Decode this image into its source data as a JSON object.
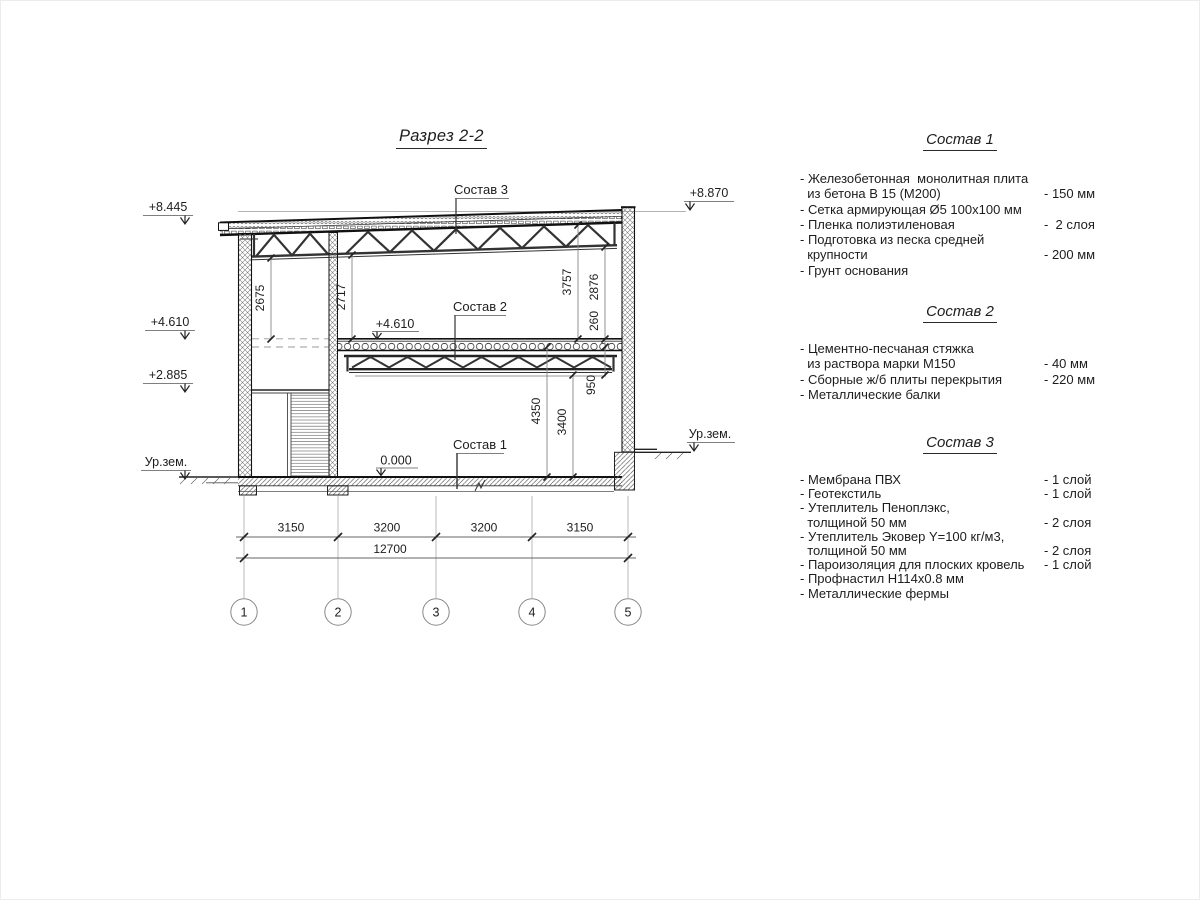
{
  "title": "Разрез 2-2",
  "section": {
    "leaders": {
      "sostav1": "Состав 1",
      "sostav2": "Состав 2",
      "sostav3": "Состав 3"
    },
    "elevations": {
      "roof_left": "+8.445",
      "roof_right": "+8.870",
      "mid_left": "+4.610",
      "mid_inner": "+4.610",
      "landing_left": "+2.885",
      "ground_left": "Ур.зем.",
      "ground_right": "Ур.зем.",
      "floor_zero": "0.000"
    },
    "dims_vertical": {
      "d2675": "2675",
      "d2717": "2717",
      "d3757": "3757",
      "d2876": "2876",
      "d260": "260",
      "d950": "950",
      "d4350": "4350",
      "d3400": "3400"
    },
    "dims_horizontal": {
      "spans": [
        "3150",
        "3200",
        "3200",
        "3150"
      ],
      "total": "12700"
    },
    "axes": [
      "1",
      "2",
      "3",
      "4",
      "5"
    ]
  },
  "specs": [
    {
      "title": "Состав 1",
      "items": [
        {
          "text": "- Железобетонная  монолитная плита",
          "value": ""
        },
        {
          "text": "  из бетона В 15 (М200)",
          "value": "- 150 мм"
        },
        {
          "text": "- Сетка армирующая Ø5 100х100 мм",
          "value": ""
        },
        {
          "text": "- Пленка полиэтиленовая",
          "value": "-  2 слоя"
        },
        {
          "text": "- Подготовка из песка средней",
          "value": ""
        },
        {
          "text": "  крупности",
          "value": "- 200 мм"
        },
        {
          "text": "- Грунт основания",
          "value": ""
        }
      ]
    },
    {
      "title": "Состав 2",
      "items": [
        {
          "text": "- Цементно-песчаная стяжка",
          "value": ""
        },
        {
          "text": "  из раствора марки М150",
          "value": "- 40 мм"
        },
        {
          "text": "- Сборные ж/б плиты перекрытия",
          "value": "- 220 мм"
        },
        {
          "text": "- Металлические балки",
          "value": ""
        }
      ]
    },
    {
      "title": "Состав 3",
      "items": [
        {
          "text": "- Мембрана ПВХ",
          "value": "- 1 слой"
        },
        {
          "text": "- Геотекстиль",
          "value": "- 1 слой"
        },
        {
          "text": "- Утеплитель Пеноплэкс,",
          "value": ""
        },
        {
          "text": "  толщиной 50 мм",
          "value": "- 2 слоя"
        },
        {
          "text": "- Утеплитель Эковер Y=100 кг/м3,",
          "value": ""
        },
        {
          "text": "  толщиной 50 мм",
          "value": "- 2 слоя"
        },
        {
          "text": "- Пароизоляция для плоских кровель",
          "value": "- 1 слой"
        },
        {
          "text": "- Профнастил Н114х0.8 мм",
          "value": ""
        },
        {
          "text": "- Металлические фермы",
          "value": ""
        }
      ]
    }
  ]
}
